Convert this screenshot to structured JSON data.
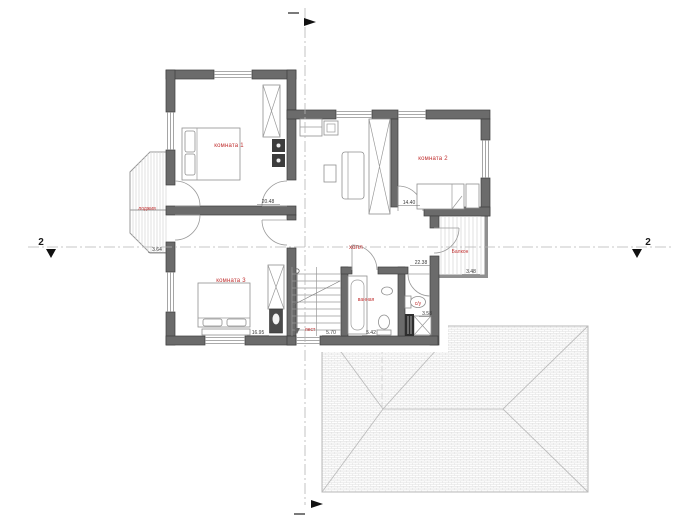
{
  "document": {
    "type": "floor-plan-drawing"
  },
  "plan": {
    "rooms": [
      {
        "id": "room1",
        "label": "комната 1",
        "area": "20.48"
      },
      {
        "id": "room2",
        "label": "комната 2",
        "area": "14.40"
      },
      {
        "id": "room3",
        "label": "комната 3",
        "area": "16.95"
      },
      {
        "id": "hall",
        "label": "холл",
        "area": "22.38"
      },
      {
        "id": "stairs",
        "label": "лест",
        "area": "5.70"
      },
      {
        "id": "bathroom",
        "label": "ванная",
        "area": "5.42"
      },
      {
        "id": "wc",
        "label": "с/у",
        "area": "3.58"
      },
      {
        "id": "loggia",
        "label": "лоджия",
        "area": "3.64"
      },
      {
        "id": "balcony",
        "label": "Балкон",
        "area": "3.48"
      }
    ],
    "axes": {
      "section_left": "2",
      "section_right": "2"
    },
    "colors": {
      "wall": "#6b6b6b",
      "wall_edge": "#3e3e3e",
      "room_label": "#c03030",
      "dimension": "#3a3a3a",
      "roof_line": "#bdbdbd"
    }
  }
}
